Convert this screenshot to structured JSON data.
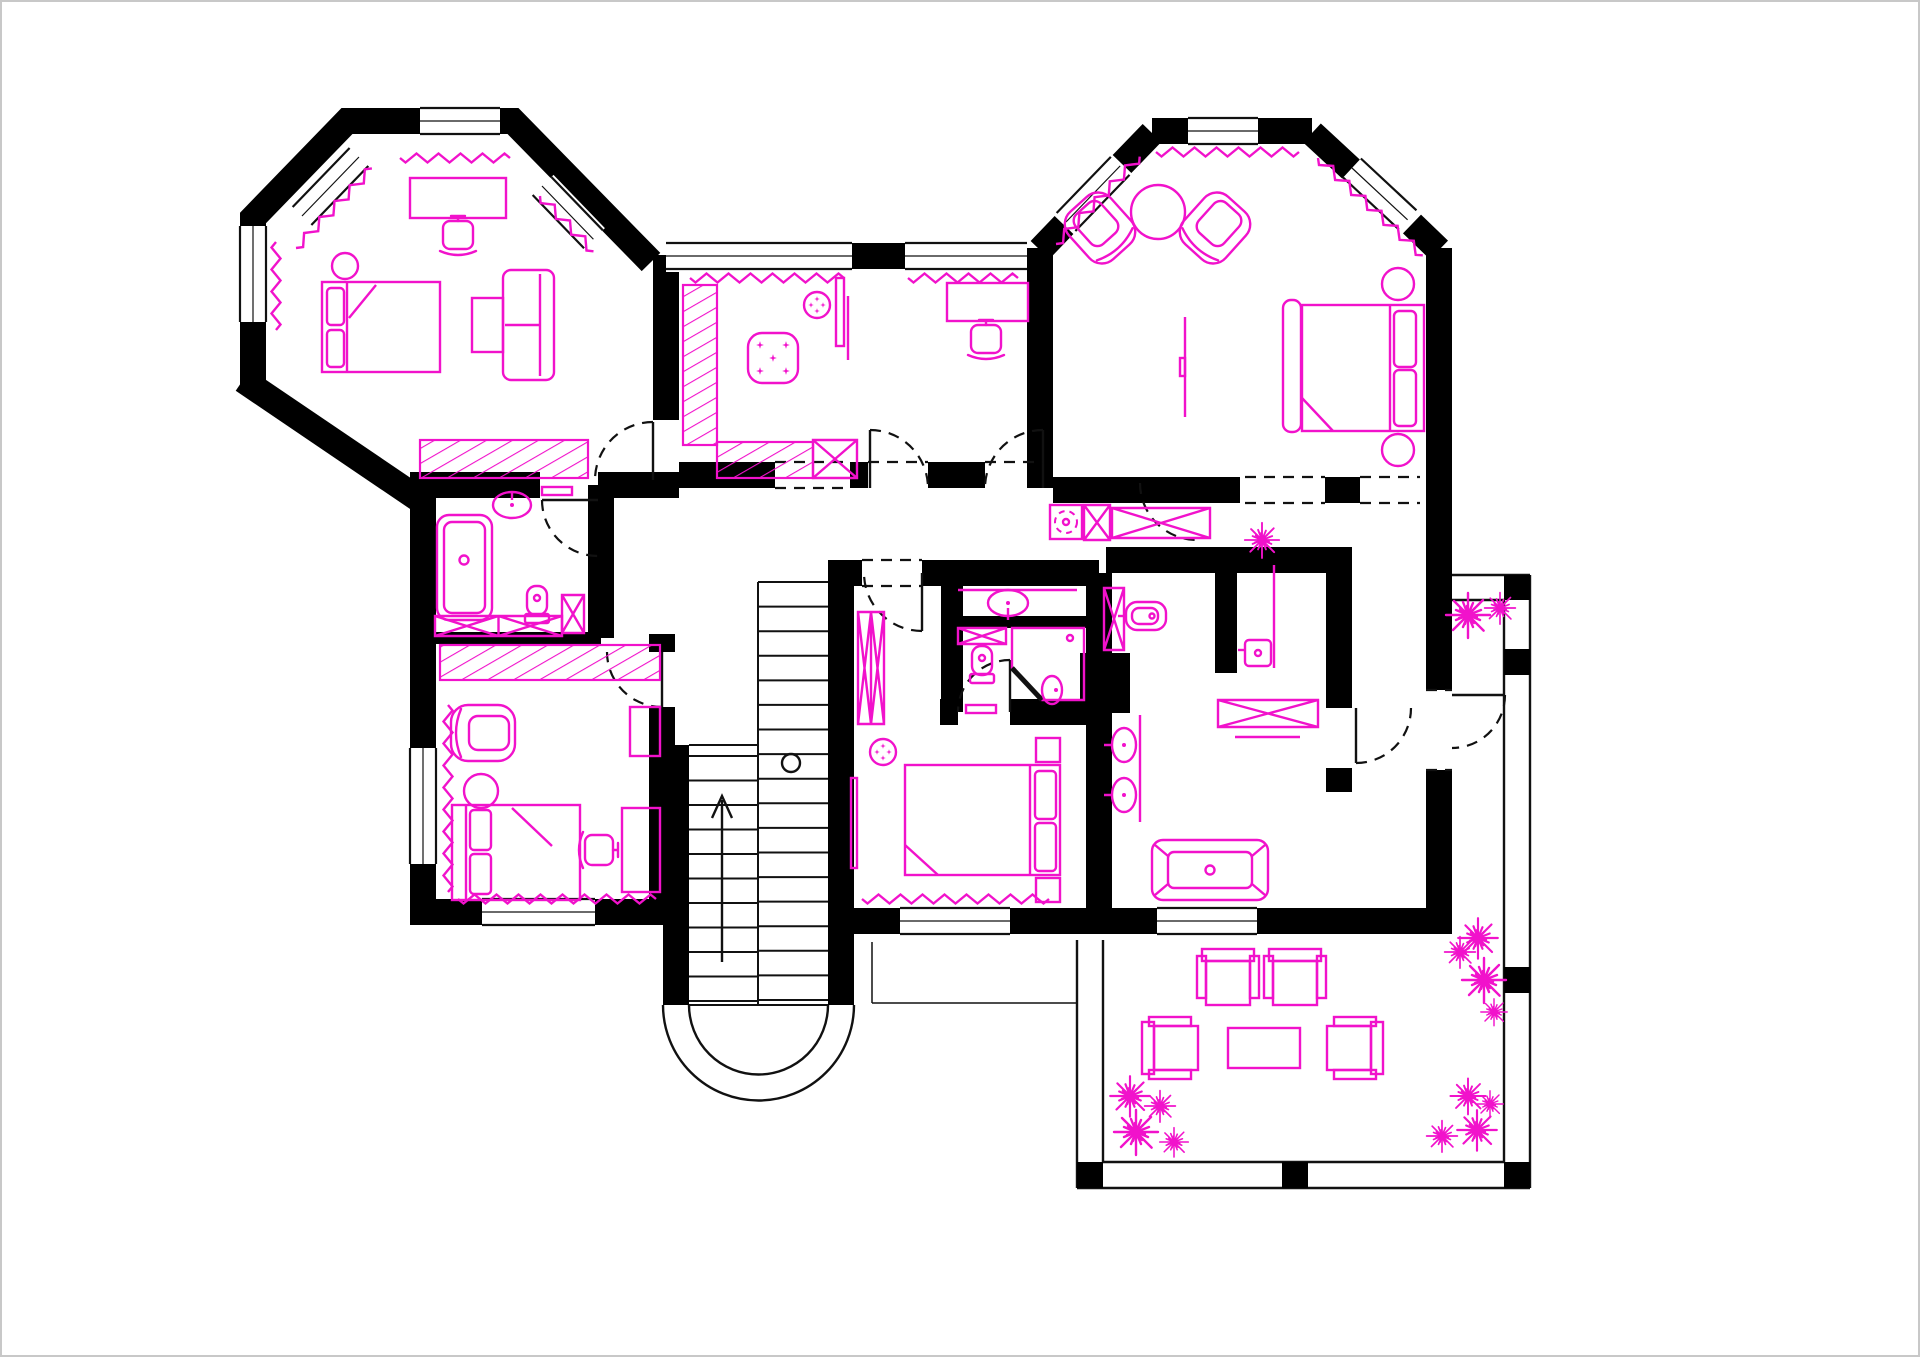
{
  "document": {
    "kind": "architectural floor plan",
    "floor": "upper floor",
    "notes": "CAD style plan: black structural walls, thin black stair/door linework, magenta furniture and fixtures, no visible text labels"
  },
  "palette": {
    "wall": "#000000",
    "furniture": "#f112cb",
    "line": "#111111",
    "glass": "#8a8a8a",
    "background": "#ffffff",
    "frame": "#c8c8c8"
  },
  "rooms": [
    {
      "id": "bedroom-1",
      "label": "Bedroom (octagonal bay)",
      "furniture": [
        "double bed with two pillows",
        "round bedside table",
        "desk",
        "desk chair",
        "two-seat sofa",
        "side table",
        "hatched wardrobe",
        "window curtains (zigzag)"
      ]
    },
    {
      "id": "walk-in-closet",
      "label": "Walk-in closet",
      "furniture": [
        "L-shaped hatched wardrobe",
        "cross cabinet",
        "square ottoman with stars",
        "round pouf",
        "mirror panel"
      ]
    },
    {
      "id": "study",
      "label": "Study",
      "furniture": [
        "desk",
        "desk chair",
        "window curtain (zigzag)"
      ]
    },
    {
      "id": "master-bedroom",
      "label": "Master bedroom (octagonal bay)",
      "furniture": [
        "double bed",
        "tufted foot bench",
        "two round nightstands",
        "two armchairs",
        "round coffee table",
        "TV panel",
        "window curtains (zigzag)"
      ]
    },
    {
      "id": "bathroom-1",
      "label": "Bathroom",
      "furniture": [
        "bathtub",
        "washbasin",
        "toilet",
        "tall cabinet",
        "low cross cabinets"
      ]
    },
    {
      "id": "bedroom-2",
      "label": "Bedroom (lower left)",
      "furniture": [
        "double bed with two pillows",
        "armchair",
        "round side table",
        "desk",
        "desk chair",
        "dresser",
        "hatched wardrobe",
        "window curtains (zigzag)"
      ]
    },
    {
      "id": "hall-landing",
      "label": "Hall / landing",
      "furniture": []
    },
    {
      "id": "staircase",
      "label": "U-shaped staircase",
      "furniture": [
        "two flights of treads",
        "center stringer",
        "up arrow",
        "newel circle",
        "semicircular end wall"
      ]
    },
    {
      "id": "corridor",
      "label": "Corridor / laundry niche",
      "furniture": [
        "washing machine (dashed drum)",
        "cross cabinet",
        "wide low cabinet",
        "potted plant"
      ]
    },
    {
      "id": "bedroom-3",
      "label": "Bedroom (center bottom)",
      "furniture": [
        "double bed with two pillows",
        "two nightstands",
        "round pouf",
        "mirror",
        "tall cross wardrobe",
        "window curtain (zigzag)"
      ]
    },
    {
      "id": "ensuite-bathroom",
      "label": "En-suite bathroom",
      "furniture": [
        "vanity washbasin",
        "toilet",
        "corner shower",
        "washbasin",
        "cross cabinet",
        "rug"
      ]
    },
    {
      "id": "master-bathroom",
      "label": "Master bathroom",
      "furniture": [
        "freestanding bathtub",
        "double washbasins with vanity",
        "bidet",
        "shower stall with glass screen",
        "cross bench cabinet",
        "tall cross cabinet",
        "towel rail"
      ]
    },
    {
      "id": "terrace",
      "label": "Terrace",
      "furniture": [
        "four outdoor armchairs",
        "outdoor coffee table",
        "railing with posts",
        "thirteen potted plants"
      ]
    }
  ],
  "counts": {
    "door_swings": 10,
    "cased_openings": 5,
    "windows": 13,
    "plants": 14
  }
}
